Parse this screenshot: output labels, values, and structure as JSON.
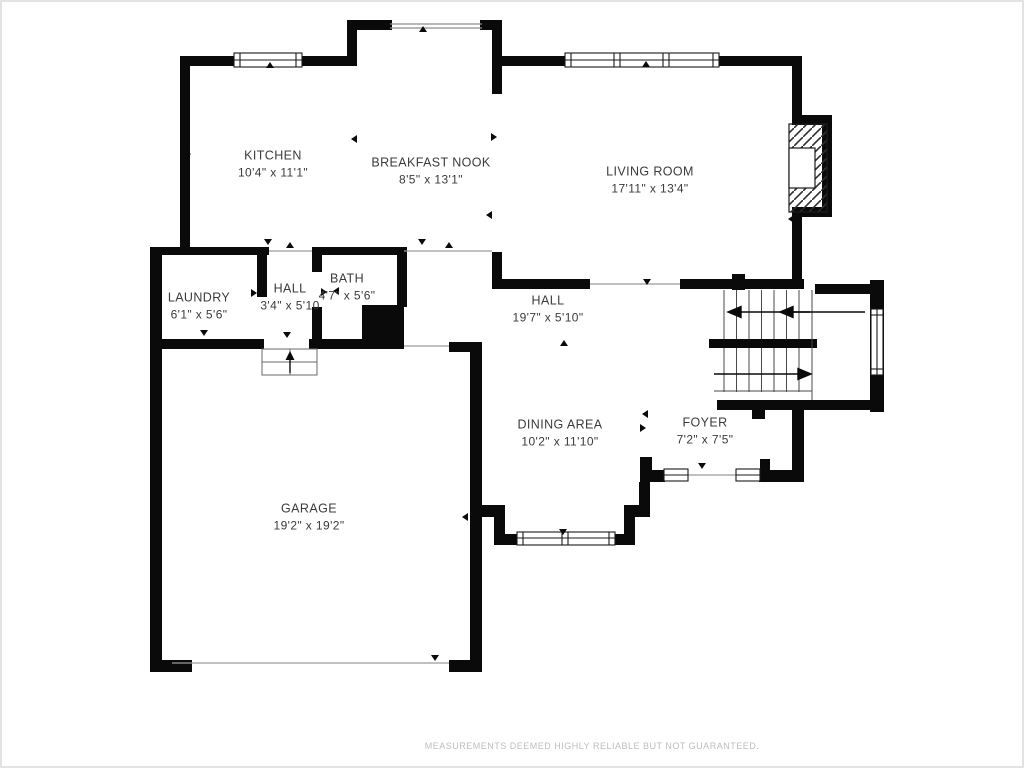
{
  "plan": {
    "title": "floor-plan",
    "disclaimer": "MEASUREMENTS DEEMED HIGHLY RELIABLE BUT NOT GUARANTEED.",
    "colors": {
      "wall": "#0a0a0a",
      "room_text": "#3b3b3b",
      "disclaimer_text": "#bdbdbd",
      "thin_line": "#9a9a9a",
      "background": "#ffffff"
    },
    "rooms": [
      {
        "name": "KITCHEN",
        "dims": "10'4\" x 11'1\"",
        "x": 271,
        "y": 162
      },
      {
        "name": "BREAKFAST NOOK",
        "dims": "8'5\" x 13'1\"",
        "x": 429,
        "y": 169
      },
      {
        "name": "LIVING ROOM",
        "dims": "17'11\" x 13'4\"",
        "x": 648,
        "y": 178
      },
      {
        "name": "LAUNDRY",
        "dims": "6'1\" x 5'6\"",
        "x": 197,
        "y": 304
      },
      {
        "name": "HALL",
        "dims": "3'4\" x 5'10",
        "x": 288,
        "y": 295
      },
      {
        "name": "BATH",
        "dims": "4'7\" x 5'6\"",
        "x": 345,
        "y": 285
      },
      {
        "name": "HALL",
        "dims": "19'7\" x 5'10\"",
        "x": 546,
        "y": 307
      },
      {
        "name": "DINING AREA",
        "dims": "10'2\" x 11'10\"",
        "x": 558,
        "y": 431
      },
      {
        "name": "FOYER",
        "dims": "7'2\" x 7'5\"",
        "x": 703,
        "y": 429
      },
      {
        "name": "GARAGE",
        "dims": "19'2\" x 19'2\"",
        "x": 307,
        "y": 515
      }
    ]
  }
}
